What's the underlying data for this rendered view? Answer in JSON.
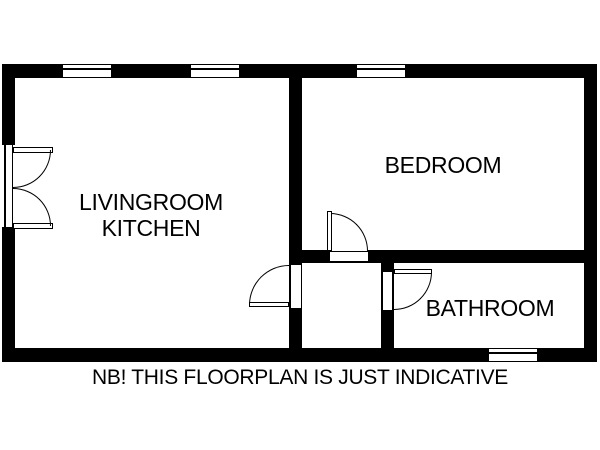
{
  "floorplan": {
    "colors": {
      "wall": "#000000",
      "background": "#ffffff"
    },
    "rooms": {
      "living": {
        "line1": "LIVINGROOM",
        "line2": "KITCHEN"
      },
      "bedroom": {
        "label": "BEDROOM"
      },
      "bathroom": {
        "label": "BATHROOM"
      }
    },
    "note": "NB! THIS FLOORPLAN IS JUST INDICATIVE",
    "symbols": {
      "windows": [
        "window-livingroom-left",
        "window-livingroom-right",
        "window-bedroom",
        "window-bathroom"
      ],
      "doors": [
        "entry-double-door",
        "livingroom-hall-door",
        "bedroom-door",
        "bathroom-door"
      ]
    }
  }
}
